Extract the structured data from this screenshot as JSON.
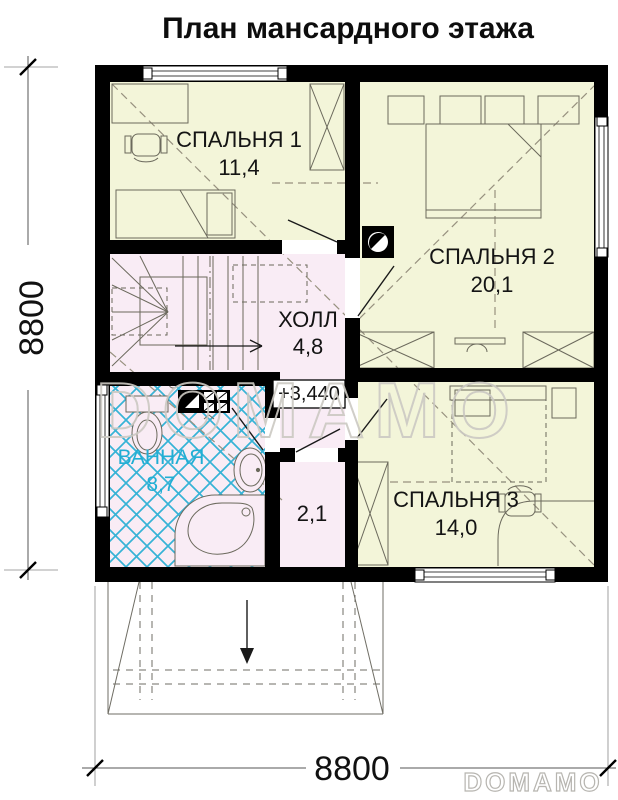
{
  "title": "План мансардного этажа",
  "plan": {
    "rooms": [
      {
        "key": "bedroom1",
        "name": "СПАЛЬНЯ 1",
        "area": "11,4"
      },
      {
        "key": "bedroom2",
        "name": "СПАЛЬНЯ 2",
        "area": "20,1"
      },
      {
        "key": "hall",
        "name": "ХОЛЛ",
        "area": "4,8"
      },
      {
        "key": "bathroom",
        "name": "ВАННАЯ",
        "area": "8,7"
      },
      {
        "key": "bedroom3",
        "name": "СПАЛЬНЯ 3",
        "area": "14,0"
      },
      {
        "key": "closet",
        "name": "",
        "area": "2,1"
      }
    ],
    "elevation_mark": "+3,440"
  },
  "dimensions": {
    "left": "8800",
    "bottom": "8800"
  },
  "watermarks": {
    "center": "DOMAMO",
    "corner": "DOMAMO"
  },
  "icons": [
    "chimney-flue-icon",
    "ventilation-circle-icon",
    "stairs-direction-arrow",
    "entrance-arrow"
  ],
  "colors": {
    "wall": "#000000",
    "room_yellow": "#f3f5d9",
    "room_pink": "#f9ecf5",
    "tile_blue": "#36b3d6",
    "bathroom_label": "#21aed4"
  }
}
